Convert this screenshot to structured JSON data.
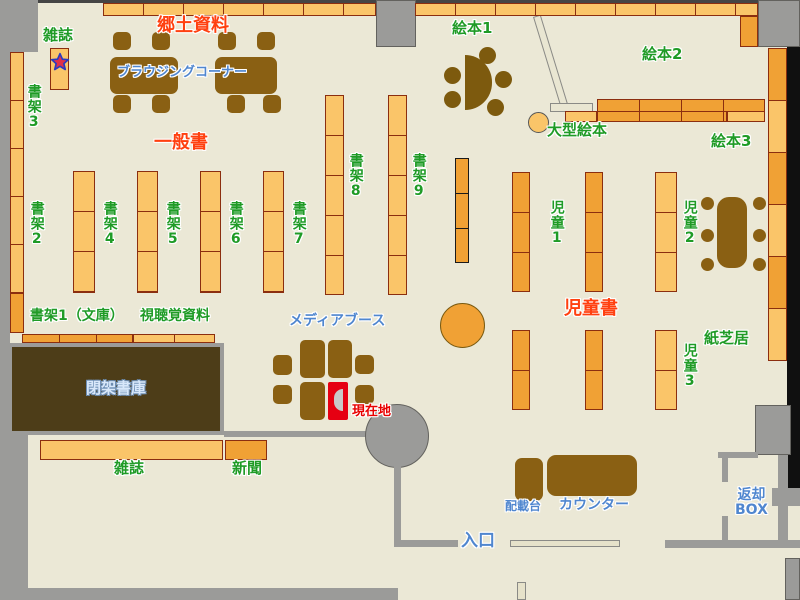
{
  "title": "図書館フロアマップ",
  "labels": {
    "magazine_top": "雑誌",
    "local_history": "郷土資料",
    "browsing_corner": "ブラウジングコーナー",
    "shelf3": "書架3",
    "general_books": "一般書",
    "shelf2": "書架2",
    "shelf4": "書架4",
    "shelf5": "書架5",
    "shelf6": "書架6",
    "shelf7": "書架7",
    "shelf8": "書架8",
    "shelf9": "書架9",
    "picture_book1": "絵本1",
    "picture_book2": "絵本2",
    "picture_book3": "絵本3",
    "large_picture_book": "大型絵本",
    "children1": "児童1",
    "children2": "児童2",
    "children3": "児童3",
    "children_books": "児童書",
    "shelf1_bunko": "書架1（文庫）",
    "av_materials": "視聴覚資料",
    "media_booth": "メディアブース",
    "current_location": "現在地",
    "closed_stacks": "閉架書庫",
    "kamishibai": "紙芝居",
    "magazine_bottom": "雑誌",
    "newspaper": "新聞",
    "distribution_stand": "配載台",
    "counter": "カウンター",
    "return_box_line1": "返却",
    "return_box_line2": "BOX",
    "entrance": "入口"
  },
  "icons": {
    "magazine_star": "star",
    "current_location_person": "half-circle-figure"
  },
  "theme": {
    "floor": "#ebe8d6",
    "wall_gray": "#9b9b99",
    "shelf_light": "#fac569",
    "shelf_dark": "#f0a135",
    "shelf_border": "#8b2e0f",
    "furniture_brown": "#8a6013",
    "closed_stacks_brown": "#4d3d18",
    "text_green": "#1f9b26",
    "text_red": "#ff4010",
    "text_blue": "#4f86cf",
    "marker_red": "#e60012",
    "star_red": "#e0304a",
    "star_blue": "#2b3bc0"
  }
}
